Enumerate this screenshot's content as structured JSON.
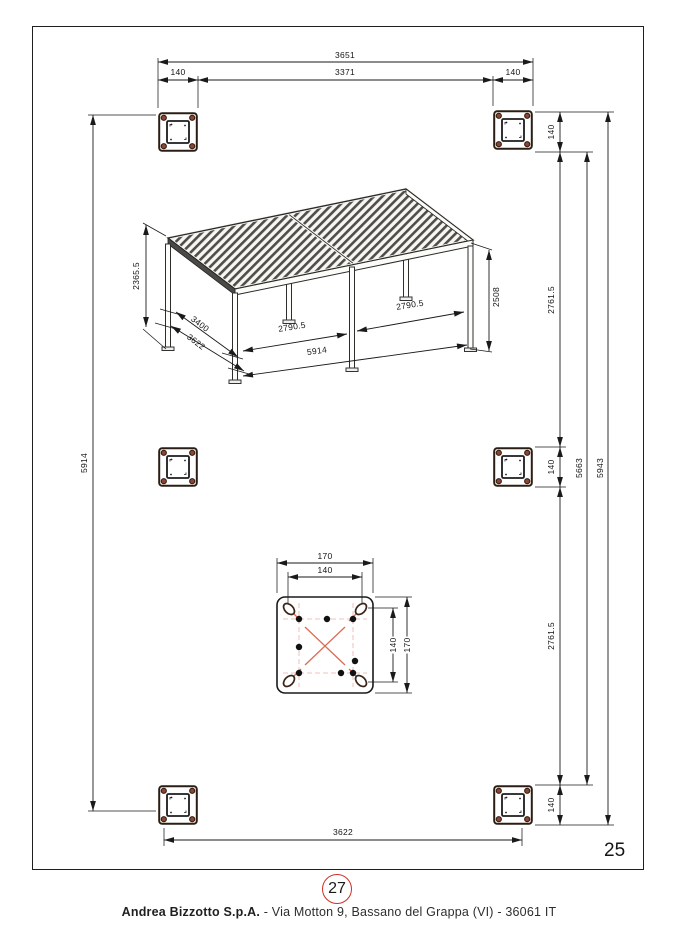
{
  "page": {
    "number": "25",
    "sheet_ref": "27",
    "footer_company": "Andrea Bizzotto S.p.A.",
    "footer_address": " - Via Motton 9, Bassano del Grappa (VI) - 36061 IT"
  },
  "plan_dims": {
    "overall_width": "3651",
    "inner_width": "3371",
    "post_size": "140",
    "bay_spacing": "2761.5",
    "inner_height": "5663",
    "overall_height": "5943",
    "left_height": "5914",
    "bottom_width": "3622"
  },
  "pergola_dims": {
    "front_height": "2365.5",
    "depth_inner": "3400",
    "depth_outer": "3622",
    "bay_length": "2790.5",
    "total_length": "5914",
    "back_height": "2508"
  },
  "detail_dims": {
    "plate_size": "170",
    "bolt_spacing": "140"
  },
  "colors": {
    "accent_red": "#cf2e26",
    "bolt_brown": "#8a4631",
    "construction_red": "#e08a77"
  }
}
